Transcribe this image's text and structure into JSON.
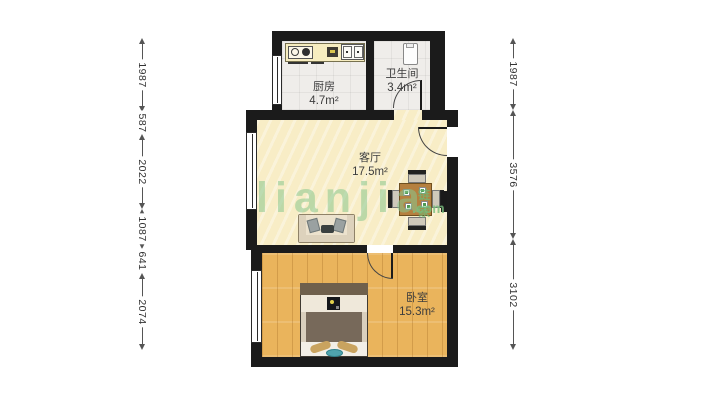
{
  "watermark": {
    "logo_text": "lianjia",
    "cjk_text": "链家",
    "com_text": ".com"
  },
  "rooms": [
    {
      "name": "厨房",
      "area": "4.7m²"
    },
    {
      "name": "卫生间",
      "area": "3.4m²"
    },
    {
      "name": "客厅",
      "area": "17.5m²"
    },
    {
      "name": "卧室",
      "area": "15.3m²"
    }
  ],
  "dimensions": {
    "left": [
      "1987",
      "587",
      "2022",
      "1087",
      "641",
      "2074"
    ],
    "right": [
      "1987",
      "3576",
      "3102"
    ]
  },
  "colors": {
    "wall": "#1b1b1b",
    "living_floor": "#f8edc6",
    "bedroom_floor": "#eab45c",
    "tile_floor": "#efedea",
    "watermark_green": "#86c38a"
  }
}
